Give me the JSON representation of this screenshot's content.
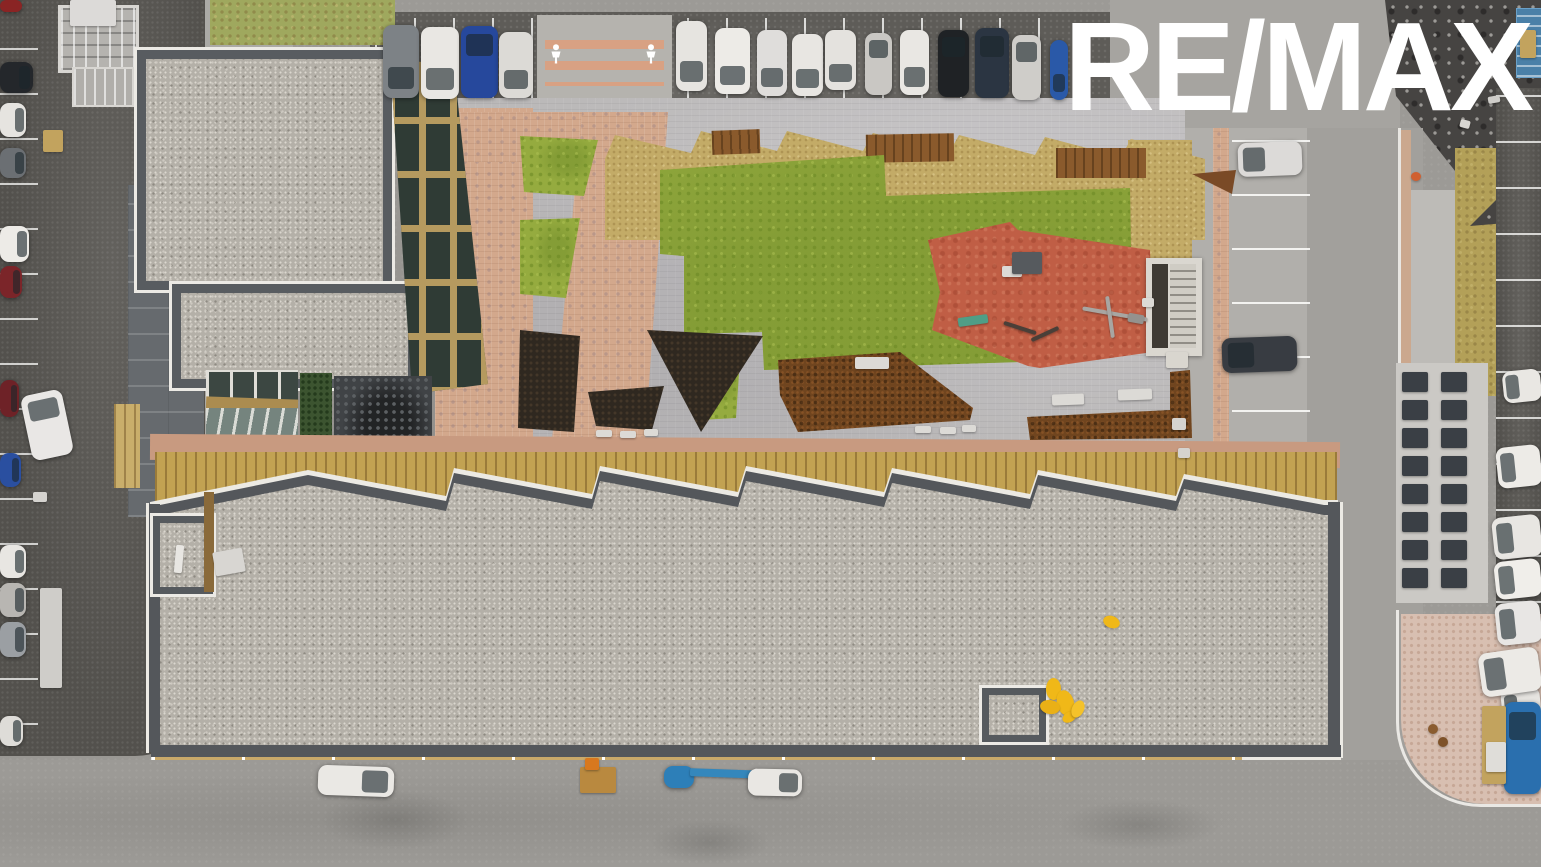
{
  "watermark": {
    "brand": "RE/MAX"
  },
  "palette": {
    "road": "#9c9a96",
    "dark_asphalt": "#5e5c58",
    "gravel_roof": "#b4b0a8",
    "lawn_green": "#95ab3f",
    "straw_mulch": "#c3ab67",
    "pink_pavers": "#d3a88c",
    "playground_red": "#c05e45",
    "corten_steel": "#70451f",
    "wood_facade": "#c2a252",
    "white_trim": "#eceae4",
    "logo_white": "#ffffff",
    "safety_yellow": "#f0b818",
    "machine_blue": "#2d7fb8"
  },
  "objects": {
    "cars_top_row": [
      {
        "name": "car",
        "x": 383,
        "y": 25,
        "w": 36,
        "h": 73,
        "c": "#7d8286",
        "cls": "car",
        "g": "b"
      },
      {
        "name": "car",
        "x": 421,
        "y": 27,
        "w": 38,
        "h": 72,
        "c": "#e9e7e3",
        "cls": "car",
        "g": "b"
      },
      {
        "name": "car",
        "x": 461,
        "y": 26,
        "w": 37,
        "h": 72,
        "c": "#26489c",
        "cls": "car",
        "g": "t"
      },
      {
        "name": "car",
        "x": 499,
        "y": 32,
        "w": 34,
        "h": 66,
        "c": "#dcdad6",
        "cls": "car",
        "g": "b"
      },
      {
        "name": "car",
        "x": 676,
        "y": 21,
        "w": 31,
        "h": 70,
        "c": "#e6e4e0",
        "cls": "car",
        "g": "b"
      },
      {
        "name": "car",
        "x": 715,
        "y": 28,
        "w": 35,
        "h": 66,
        "c": "#edebe7",
        "cls": "car",
        "g": "b"
      },
      {
        "name": "car",
        "x": 757,
        "y": 30,
        "w": 30,
        "h": 66,
        "c": "#dfdddb",
        "cls": "car",
        "g": "b"
      },
      {
        "name": "car",
        "x": 792,
        "y": 34,
        "w": 31,
        "h": 62,
        "c": "#e8e6e2",
        "cls": "car",
        "g": "b"
      },
      {
        "name": "car",
        "x": 825,
        "y": 30,
        "w": 31,
        "h": 60,
        "c": "#e4e2de",
        "cls": "car",
        "g": "b"
      },
      {
        "name": "car",
        "x": 865,
        "y": 33,
        "w": 27,
        "h": 62,
        "c": "#c9c7c3",
        "cls": "car",
        "g": "t"
      },
      {
        "name": "car",
        "x": 900,
        "y": 30,
        "w": 29,
        "h": 65,
        "c": "#e9e7e3",
        "cls": "car",
        "g": "b"
      },
      {
        "name": "car",
        "x": 938,
        "y": 30,
        "w": 31,
        "h": 67,
        "c": "#1f2225",
        "cls": "car",
        "g": "t"
      },
      {
        "name": "car",
        "x": 975,
        "y": 28,
        "w": 34,
        "h": 70,
        "c": "#2b3542",
        "cls": "car",
        "g": "t"
      },
      {
        "name": "car",
        "x": 1012,
        "y": 35,
        "w": 29,
        "h": 65,
        "c": "#cfcdc9",
        "cls": "car",
        "g": "t"
      },
      {
        "name": "car",
        "x": 1050,
        "y": 40,
        "w": 18,
        "h": 60,
        "c": "#2a59a8",
        "cls": "car",
        "g": "b"
      }
    ],
    "cars_left_column": [
      {
        "name": "car",
        "x": 0,
        "y": 0,
        "w": 22,
        "h": 12,
        "c": "#8a2424",
        "cls": "car"
      },
      {
        "name": "car",
        "x": 0,
        "y": 62,
        "w": 33,
        "h": 31,
        "c": "#24272b",
        "cls": "car",
        "g": "r"
      },
      {
        "name": "car",
        "x": 0,
        "y": 103,
        "w": 26,
        "h": 34,
        "c": "#e6e4e0",
        "cls": "car",
        "g": "r"
      },
      {
        "name": "car",
        "x": 0,
        "y": 148,
        "w": 26,
        "h": 30,
        "c": "#6b6f73",
        "cls": "car",
        "g": "r"
      },
      {
        "name": "car",
        "x": 0,
        "y": 226,
        "w": 29,
        "h": 36,
        "c": "#edebe7",
        "cls": "car",
        "g": "r"
      },
      {
        "name": "car",
        "x": 0,
        "y": 266,
        "w": 22,
        "h": 32,
        "c": "#7b2529",
        "cls": "car",
        "g": "r"
      },
      {
        "name": "car",
        "x": 0,
        "y": 380,
        "w": 19,
        "h": 37,
        "c": "#6e2227",
        "cls": "car",
        "g": "r"
      },
      {
        "name": "van",
        "x": 26,
        "y": 392,
        "w": 42,
        "h": 66,
        "c": "#e9e7e5",
        "cls": "car",
        "g": "t",
        "rot": -12
      },
      {
        "name": "car",
        "x": 0,
        "y": 453,
        "w": 21,
        "h": 34,
        "c": "#2a4fa0",
        "cls": "car",
        "g": "r"
      },
      {
        "name": "car",
        "x": 0,
        "y": 545,
        "w": 26,
        "h": 33,
        "c": "#e8e6e2",
        "cls": "car",
        "g": "r"
      },
      {
        "name": "car",
        "x": 0,
        "y": 583,
        "w": 26,
        "h": 34,
        "c": "#b8b6b2",
        "cls": "car",
        "g": "r"
      },
      {
        "name": "car",
        "x": 0,
        "y": 622,
        "w": 26,
        "h": 35,
        "c": "#9b9fa3",
        "cls": "car",
        "g": "r"
      },
      {
        "name": "car",
        "x": 0,
        "y": 716,
        "w": 23,
        "h": 30,
        "c": "#dedcd8",
        "cls": "car",
        "g": "r"
      }
    ],
    "cars_right_lot": [
      {
        "name": "car",
        "x": 1238,
        "y": 142,
        "w": 64,
        "h": 34,
        "c": "#dcdad8",
        "cls": "car",
        "g": "l",
        "rot": -2
      },
      {
        "name": "car",
        "x": 1222,
        "y": 337,
        "w": 75,
        "h": 35,
        "c": "#383c42",
        "cls": "car",
        "g": "l",
        "rot": -2
      }
    ],
    "cars_far_right": [
      {
        "name": "car",
        "x": 1503,
        "y": 370,
        "w": 38,
        "h": 32,
        "c": "#e9e7e3",
        "cls": "car",
        "g": "l",
        "rot": -6
      },
      {
        "name": "car",
        "x": 1497,
        "y": 446,
        "w": 44,
        "h": 41,
        "c": "#edebe7",
        "cls": "car",
        "g": "l",
        "rot": -6
      },
      {
        "name": "car",
        "x": 1493,
        "y": 516,
        "w": 48,
        "h": 42,
        "c": "#e8e6e2",
        "cls": "car",
        "g": "l",
        "rot": -6
      },
      {
        "name": "car",
        "x": 1495,
        "y": 560,
        "w": 46,
        "h": 38,
        "c": "#f0eeea",
        "cls": "car",
        "g": "l",
        "rot": -6
      },
      {
        "name": "car",
        "x": 1496,
        "y": 602,
        "w": 45,
        "h": 42,
        "c": "#e8e6e4",
        "cls": "car",
        "g": "l",
        "rot": -6
      },
      {
        "name": "car",
        "x": 1502,
        "y": 688,
        "w": 39,
        "h": 42,
        "c": "#e6e4e0",
        "cls": "car",
        "g": "l",
        "rot": -6
      }
    ],
    "vehicles_bottom": [
      {
        "name": "white-van",
        "x": 318,
        "y": 766,
        "w": 76,
        "h": 30,
        "c": "#eae8e4",
        "cls": "car",
        "g": "r",
        "rot": 2
      },
      {
        "name": "pallet-stack",
        "x": 580,
        "y": 767,
        "w": 36,
        "h": 26,
        "c": "#b9893f",
        "cls": "flat"
      },
      {
        "name": "forklift",
        "x": 585,
        "y": 758,
        "w": 14,
        "h": 12,
        "c": "#d8781e",
        "cls": "flat"
      },
      {
        "name": "boom-lift-base",
        "x": 664,
        "y": 766,
        "w": 30,
        "h": 22,
        "c": "#2d7fb8",
        "cls": "car"
      },
      {
        "name": "boom-lift-arm",
        "x": 690,
        "y": 770,
        "w": 106,
        "h": 8,
        "c": "#3487bc",
        "cls": "flat",
        "rot": 2
      },
      {
        "name": "white-van",
        "x": 748,
        "y": 769,
        "w": 54,
        "h": 27,
        "c": "#e9e7e3",
        "cls": "car",
        "g": "r",
        "rot": 1
      }
    ],
    "vehicles_corner": [
      {
        "name": "pickup-truck",
        "x": 1480,
        "y": 650,
        "w": 60,
        "h": 44,
        "c": "#eceae6",
        "cls": "car",
        "g": "l",
        "rot": -8
      },
      {
        "name": "blue-truck",
        "x": 1504,
        "y": 702,
        "w": 37,
        "h": 92,
        "c": "#2a6fae",
        "cls": "car",
        "g": "t"
      },
      {
        "name": "plank-stack",
        "x": 1482,
        "y": 706,
        "w": 24,
        "h": 78,
        "c": "#c2a35e",
        "cls": "flat"
      },
      {
        "name": "white-sheet-stack",
        "x": 1486,
        "y": 742,
        "w": 20,
        "h": 30,
        "c": "#dfddd9",
        "cls": "flat"
      },
      {
        "name": "timber-log",
        "x": 1428,
        "y": 724,
        "w": 10,
        "h": 10,
        "c": "#8a5c30",
        "cls": "blob"
      },
      {
        "name": "timber-log",
        "x": 1438,
        "y": 737,
        "w": 10,
        "h": 10,
        "c": "#7e5229",
        "cls": "blob"
      }
    ],
    "benches": [
      {
        "name": "bench",
        "x": 855,
        "y": 357,
        "w": 34,
        "h": 12,
        "c": "#dcdad6",
        "cls": "flat"
      },
      {
        "name": "bench",
        "x": 1052,
        "y": 394,
        "w": 32,
        "h": 11,
        "c": "#dcdad6",
        "cls": "flat",
        "rot": -2
      },
      {
        "name": "bench",
        "x": 1118,
        "y": 389,
        "w": 34,
        "h": 11,
        "c": "#dcdad6",
        "cls": "flat",
        "rot": -2
      },
      {
        "name": "bench",
        "x": 1002,
        "y": 266,
        "w": 20,
        "h": 11,
        "c": "#dcdad6",
        "cls": "flat"
      },
      {
        "name": "teal-bench",
        "x": 958,
        "y": 316,
        "w": 30,
        "h": 9,
        "c": "#4f9e86",
        "cls": "flat",
        "rot": -8
      },
      {
        "name": "bench",
        "x": 596,
        "y": 430,
        "w": 16,
        "h": 7,
        "c": "#dcdad6",
        "cls": "flat"
      },
      {
        "name": "bench",
        "x": 620,
        "y": 431,
        "w": 16,
        "h": 7,
        "c": "#dcdad6",
        "cls": "flat"
      },
      {
        "name": "bench",
        "x": 644,
        "y": 429,
        "w": 14,
        "h": 7,
        "c": "#dcdad6",
        "cls": "flat"
      },
      {
        "name": "bench",
        "x": 915,
        "y": 426,
        "w": 16,
        "h": 7,
        "c": "#dcdad6",
        "cls": "flat"
      },
      {
        "name": "bench",
        "x": 940,
        "y": 427,
        "w": 16,
        "h": 7,
        "c": "#dcdad6",
        "cls": "flat"
      },
      {
        "name": "bench",
        "x": 962,
        "y": 425,
        "w": 14,
        "h": 7,
        "c": "#dcdad6",
        "cls": "flat"
      },
      {
        "name": "bench",
        "x": 1142,
        "y": 298,
        "w": 12,
        "h": 9,
        "c": "#dcdad6",
        "cls": "flat"
      }
    ],
    "playground_equipment": [
      {
        "name": "climbing-block",
        "x": 1012,
        "y": 252,
        "w": 30,
        "h": 22,
        "c": "#565a5e",
        "cls": "flat"
      },
      {
        "name": "balance-bar",
        "x": 1003,
        "y": 326,
        "w": 34,
        "h": 4,
        "c": "#4a3f38",
        "cls": "flat",
        "rot": 18
      },
      {
        "name": "balance-bar",
        "x": 1030,
        "y": 332,
        "w": 30,
        "h": 4,
        "c": "#4a3f38",
        "cls": "flat",
        "rot": -25
      },
      {
        "name": "spinner-bar",
        "x": 1082,
        "y": 312,
        "w": 66,
        "h": 4,
        "c": "#a8a6a2",
        "cls": "flat",
        "rot": 10
      },
      {
        "name": "spinner-bar",
        "x": 1108,
        "y": 296,
        "w": 4,
        "h": 42,
        "c": "#a8a6a2",
        "cls": "flat",
        "rot": -8
      },
      {
        "name": "spinner-seat",
        "x": 1128,
        "y": 314,
        "w": 16,
        "h": 9,
        "c": "#94928e",
        "cls": "flat",
        "rot": 10
      }
    ],
    "yellow_materials": [
      {
        "name": "yellow-material",
        "x": 1103,
        "y": 616,
        "w": 17,
        "h": 12,
        "c": "#f0b818",
        "cls": "blob",
        "rot": 20
      },
      {
        "name": "yellow-material",
        "x": 1046,
        "y": 678,
        "w": 15,
        "h": 22,
        "c": "#f0b818",
        "cls": "blob"
      },
      {
        "name": "yellow-material",
        "x": 1057,
        "y": 690,
        "w": 17,
        "h": 26,
        "c": "#f0b818",
        "cls": "blob",
        "rot": -15
      },
      {
        "name": "yellow-material",
        "x": 1040,
        "y": 700,
        "w": 20,
        "h": 14,
        "c": "#eab016",
        "cls": "blob",
        "rot": 10
      },
      {
        "name": "yellow-material",
        "x": 1062,
        "y": 712,
        "w": 15,
        "h": 10,
        "c": "#f0b818",
        "cls": "blob",
        "rot": -30
      },
      {
        "name": "yellow-material",
        "x": 1072,
        "y": 700,
        "w": 12,
        "h": 18,
        "c": "#f4c22a",
        "cls": "blob",
        "rot": 25
      }
    ],
    "misc": [
      {
        "name": "drain-grate",
        "x": 33,
        "y": 492,
        "w": 14,
        "h": 10,
        "c": "#d5d3cf",
        "cls": "flat"
      },
      {
        "name": "wood-pallet",
        "x": 43,
        "y": 130,
        "w": 20,
        "h": 22,
        "c": "#c2a35e",
        "cls": "flat"
      },
      {
        "name": "plank-pile",
        "x": 40,
        "y": 588,
        "w": 22,
        "h": 100,
        "c": "#cfcdc9",
        "cls": "flat"
      },
      {
        "name": "white-sheet",
        "x": 70,
        "y": 0,
        "w": 46,
        "h": 26,
        "c": "#dcdad8",
        "cls": "flat"
      },
      {
        "name": "pallet-on-scaffold",
        "x": 1520,
        "y": 30,
        "w": 16,
        "h": 28,
        "c": "#c2a35e",
        "cls": "flat"
      },
      {
        "name": "roof-material-sheet",
        "x": 214,
        "y": 550,
        "w": 30,
        "h": 24,
        "c": "#d8d6d2",
        "cls": "flat",
        "rot": -10
      },
      {
        "name": "skylight-tube",
        "x": 175,
        "y": 545,
        "w": 8,
        "h": 28,
        "c": "#e8e6e2",
        "cls": "flat",
        "rot": 5
      },
      {
        "name": "utility-box",
        "x": 1172,
        "y": 418,
        "w": 14,
        "h": 12,
        "c": "#d5d3cf",
        "cls": "flat"
      },
      {
        "name": "utility-box",
        "x": 1178,
        "y": 448,
        "w": 12,
        "h": 10,
        "c": "#d5d3cf",
        "cls": "flat"
      },
      {
        "name": "stair-landing-box",
        "x": 1166,
        "y": 352,
        "w": 22,
        "h": 16,
        "c": "#d9d6cf",
        "cls": "flat"
      },
      {
        "name": "red-marker",
        "x": 1408,
        "y": 515,
        "w": 7,
        "h": 7,
        "c": "#c03a2a",
        "cls": "blob"
      },
      {
        "name": "orange-marker",
        "x": 1411,
        "y": 172,
        "w": 10,
        "h": 9,
        "c": "#d06030",
        "cls": "blob"
      },
      {
        "name": "debris-white",
        "x": 1460,
        "y": 120,
        "w": 10,
        "h": 8,
        "c": "#d8d6d2",
        "cls": "flat",
        "rot": 15
      },
      {
        "name": "debris-white",
        "x": 1488,
        "y": 96,
        "w": 12,
        "h": 7,
        "c": "#cfcdc9",
        "cls": "flat",
        "rot": -10
      }
    ],
    "vent_grid": {
      "grid": true,
      "name": "garage-vent-grille",
      "x": 1402,
      "y": 372,
      "cols": 2,
      "rows": 8,
      "cw": 26,
      "ch": 20,
      "gx": 13,
      "gy": 8,
      "c": "#3a3f45"
    }
  }
}
